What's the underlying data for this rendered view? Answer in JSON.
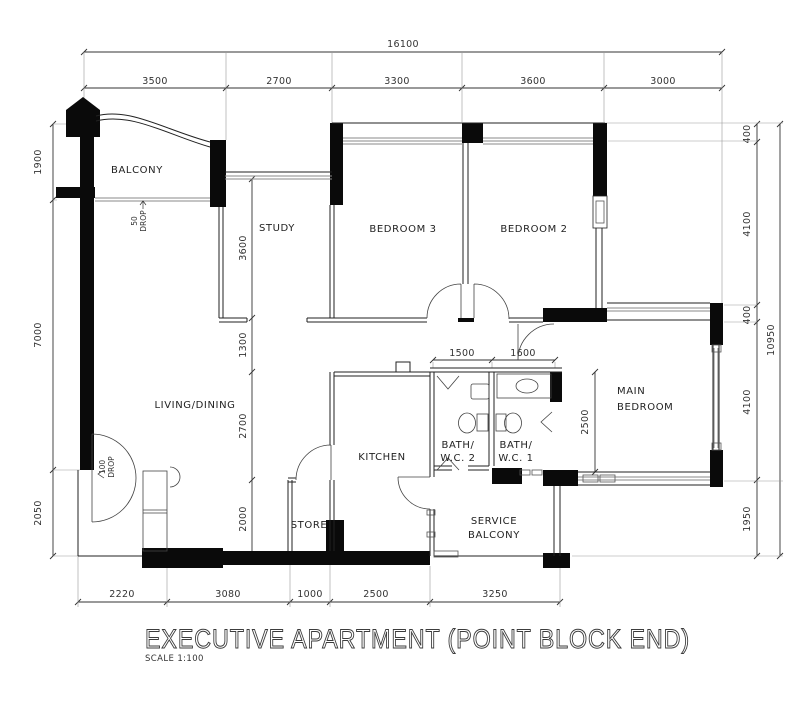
{
  "title": {
    "name": "EXECUTIVE APARTMENT (POINT BLOCK END)",
    "scale": "SCALE 1:100"
  },
  "rooms": {
    "balcony": "BALCONY",
    "study": "STUDY",
    "bedroom3": "BEDROOM 3",
    "bedroom2": "BEDROOM 2",
    "living": "LIVING/DINING",
    "kitchen": "KITCHEN",
    "bath2_line1": "BATH/",
    "bath2_line2": "W.C.  2",
    "bath1_line1": "BATH/",
    "bath1_line2": "W.C.  1",
    "main_line1": "MAIN",
    "main_line2": "BEDROOM",
    "store": "STORE",
    "service_line1": "SERVICE",
    "service_line2": "BALCONY"
  },
  "notes": {
    "balcony_drop": {
      "value": "50",
      "word": "DROP"
    },
    "entrance_drop": {
      "value": "100",
      "word": "DROP"
    }
  },
  "dimensions": {
    "top_total": "16100",
    "top": [
      "3500",
      "2700",
      "3300",
      "3600",
      "3000"
    ],
    "left": [
      "1900",
      "7000",
      "2050"
    ],
    "right": [
      "400",
      "4100",
      "400",
      "4100",
      "1950"
    ],
    "right_total": "10950",
    "bottom": [
      "2220",
      "3080",
      "1000",
      "2500",
      "3250"
    ],
    "interior_vertical": [
      "3600",
      "1300",
      "2700",
      "2000"
    ],
    "bath_widths": [
      "1500",
      "1600"
    ],
    "bedroom_depth": "2500"
  }
}
